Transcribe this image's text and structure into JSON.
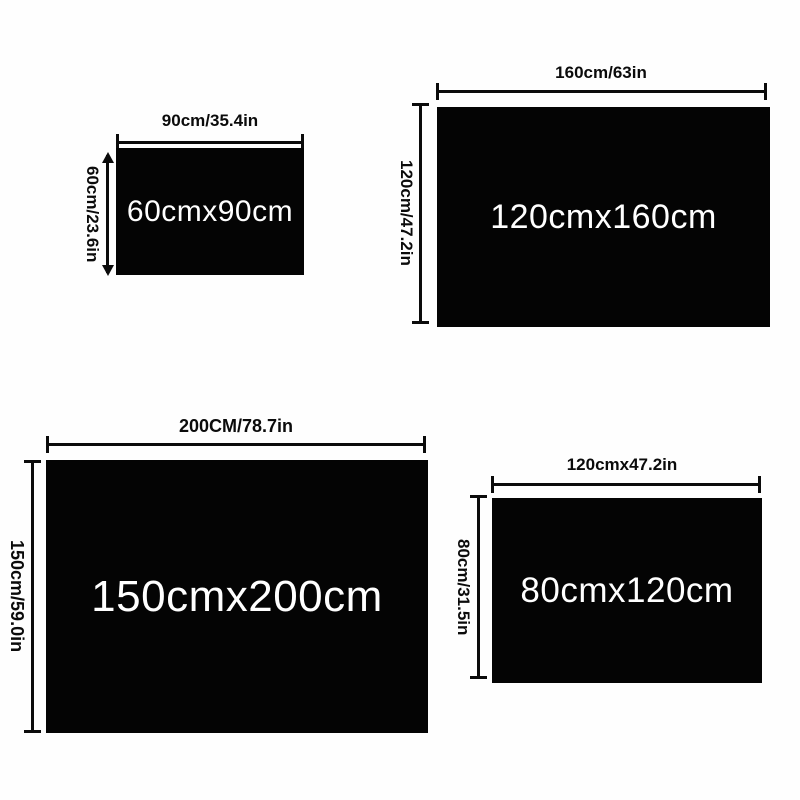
{
  "page": {
    "description": "Product size chart diagram with four black rectangles and dimension arrows",
    "background_color": "#fefefe",
    "rect_color": "#040404",
    "rect_text_color": "#ffffff",
    "dimension_color": "#0b0b0b"
  },
  "sizes": [
    {
      "id": "60x90",
      "rect_label": "60cmx90cm",
      "width_label": "90cm/35.4in",
      "height_label": "60cm/23.6in"
    },
    {
      "id": "120x160",
      "rect_label": "120cmx160cm",
      "width_label": "160cm/63in",
      "height_label": "120cm/47.2in"
    },
    {
      "id": "150x200",
      "rect_label": "150cmx200cm",
      "width_label": "200CM/78.7in",
      "height_label": "150cm/59.0in"
    },
    {
      "id": "80x120",
      "rect_label": "80cmx120cm",
      "width_label": "120cmx47.2in",
      "height_label": "80cm/31.5in"
    }
  ]
}
